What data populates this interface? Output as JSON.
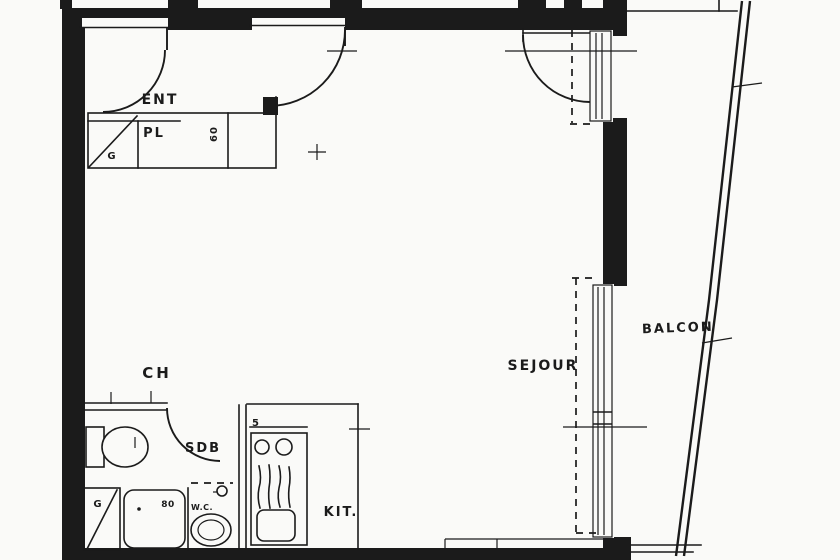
{
  "plan": {
    "labels": {
      "entry": "ENT",
      "closet": "PL",
      "closet_depth": "60",
      "duct_top": "G",
      "bedroom": "CH",
      "bathroom": "SDB",
      "shower_dim": "80",
      "wc": "W.C.",
      "duct_bottom": "G",
      "kitchen": "KIT.",
      "kitchen_mark": "5",
      "living_room": "SEJOUR",
      "balcony": "BALCON"
    },
    "colors": {
      "ink": "#1b1b1b",
      "paper": "#fafaf8"
    }
  }
}
